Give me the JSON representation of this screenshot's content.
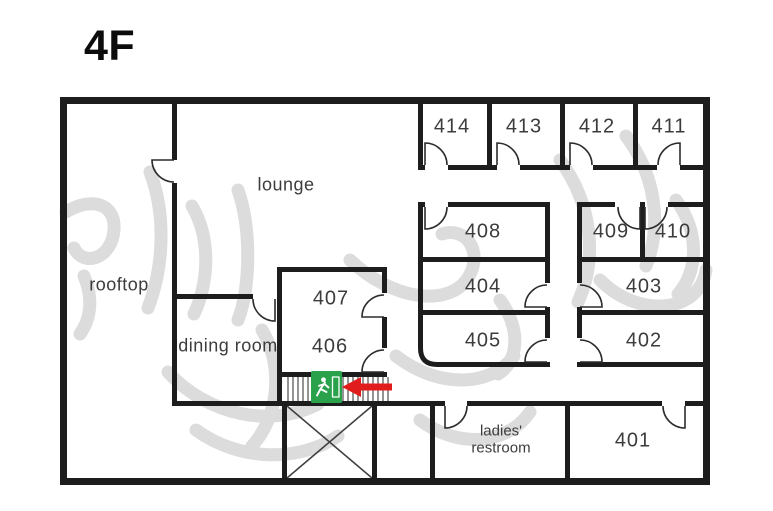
{
  "floor_title": "4F",
  "rooms": {
    "r401": "401",
    "r402": "402",
    "r403": "403",
    "r404": "404",
    "r405": "405",
    "r406": "406",
    "r407": "407",
    "r408": "408",
    "r409": "409",
    "r410": "410",
    "r411": "411",
    "r412": "412",
    "r413": "413",
    "r414": "414",
    "rooftop": "rooftop",
    "lounge": "lounge",
    "dining_room": "dining room",
    "ladies_line1": "ladies'",
    "ladies_line2": "restroom"
  },
  "markers": {
    "exit_sign": "emergency exit",
    "arrow_direction": "left"
  },
  "watermark": {
    "text": "한남동 싱글라이프 스테이",
    "color": "#dcdcdc"
  },
  "colors": {
    "wall": "#1d1d1d",
    "label_text": "#3c3c3c",
    "exit_green": "#2aa24b",
    "arrow_red": "#e11c1c",
    "background": "#ffffff"
  }
}
